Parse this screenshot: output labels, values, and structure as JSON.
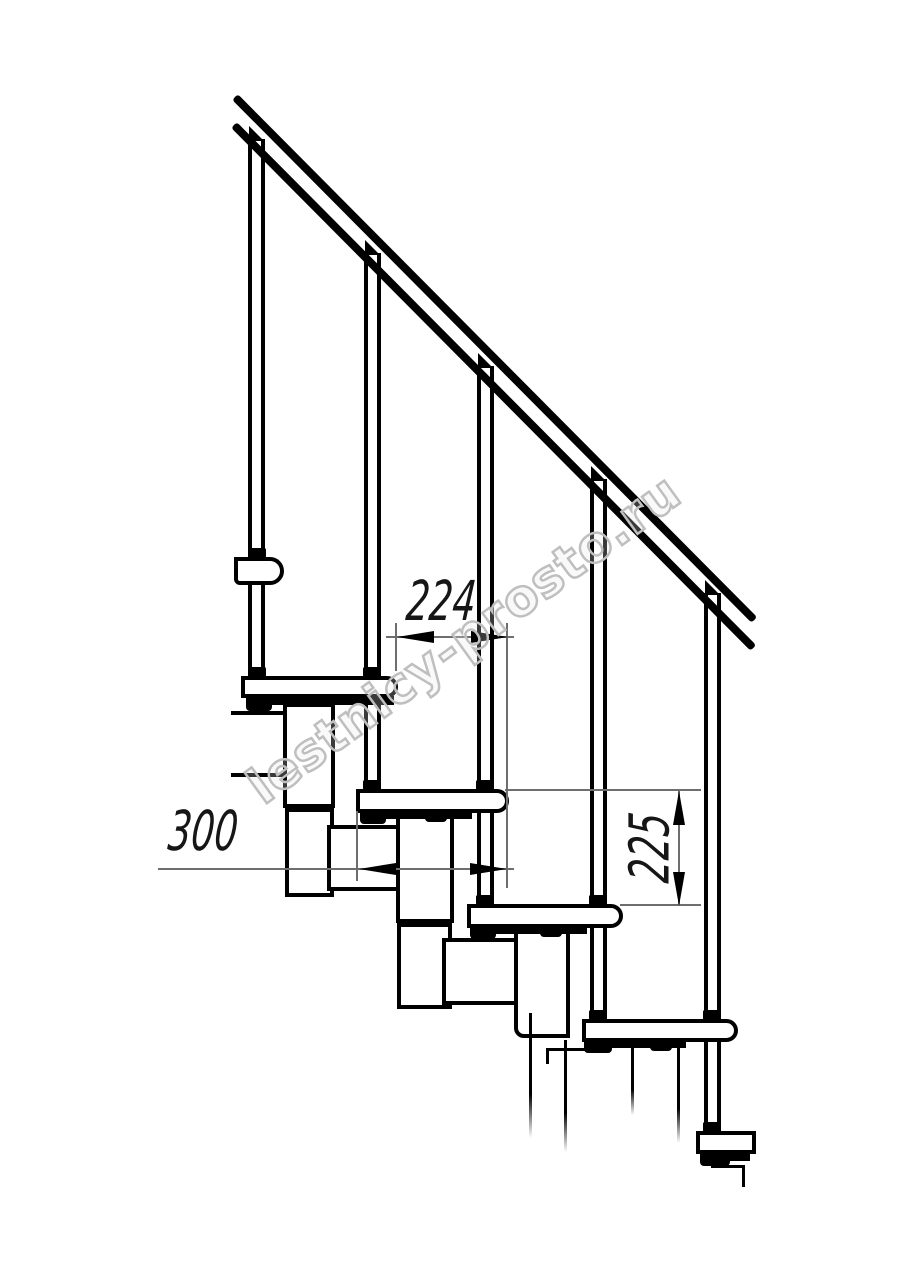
{
  "drawing": {
    "title": "modular-staircase-side-elevation",
    "watermark": "lestnicy-prosto.ru",
    "colors": {
      "line": "#000000",
      "thin_line": "#6e6e6e",
      "watermark": "#bfbfbf",
      "background": "#ffffff"
    },
    "dimensions": [
      {
        "id": "step-run-spacing",
        "value": "224",
        "orientation": "horizontal"
      },
      {
        "id": "tread-depth",
        "value": "300",
        "orientation": "horizontal"
      },
      {
        "id": "riser-height",
        "value": "225",
        "orientation": "vertical"
      }
    ],
    "counts": {
      "balusters": 5,
      "treads": 6,
      "spine_modules": 8
    }
  }
}
